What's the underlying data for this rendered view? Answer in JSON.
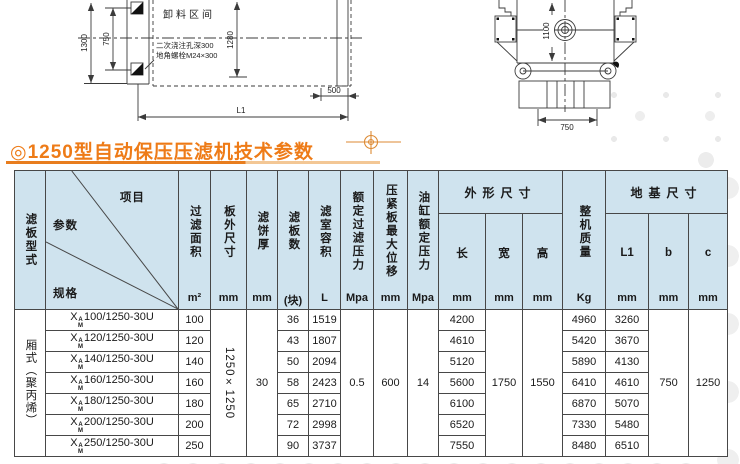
{
  "colors": {
    "accent_orange": "#ee7b17",
    "underline_light": "#f3c795",
    "header_blue": "#cfe3ee",
    "line_dark": "#3b3b3b"
  },
  "page": {
    "title": "◎1250型自动保压压滤机技术参数"
  },
  "drawing": {
    "left": {
      "dim_1300": "1300",
      "dim_750": "750",
      "dim_1280": "1280",
      "dim_500": "500",
      "dim_L1": "L1",
      "unload_zone": "卸料区间",
      "note_line1": "二次浇注孔深300",
      "note_line2": "地角螺栓M24×300"
    },
    "right": {
      "dim_1100": "1100",
      "dim_750": "750"
    }
  },
  "table": {
    "model_prefix": {
      "x": "X",
      "sup": "A",
      "sub": "M"
    },
    "plate_type_value": "厢式（聚丙烯）",
    "columns": {
      "plate_type": {
        "label": "滤板型式"
      },
      "item": "项目",
      "param": "参数",
      "spec": "规格",
      "filter_area": {
        "label": "过滤面积",
        "unit": "m²"
      },
      "plate_size": {
        "label": "板外尺寸",
        "unit": "mm"
      },
      "cake_thickness": {
        "label": "滤饼厚",
        "unit": "mm"
      },
      "plate_count": {
        "label": "滤板数",
        "unit": "(块)"
      },
      "chamber_volume": {
        "label": "滤室容积",
        "unit": "L"
      },
      "rated_filter_pressure": {
        "label": "额定过滤压力",
        "unit": "Mpa"
      },
      "max_displacement": {
        "label": "压紧板最大位移",
        "unit": "mm"
      },
      "cylinder_pressure": {
        "label": "油缸额定压力",
        "unit": "Mpa"
      },
      "overall_size": {
        "label": "外形尺寸"
      },
      "length": {
        "label": "长",
        "unit": "mm"
      },
      "width": {
        "label": "宽",
        "unit": "mm"
      },
      "height": {
        "label": "高",
        "unit": "mm"
      },
      "machine_weight": {
        "label": "整机质量",
        "unit": "Kg"
      },
      "foundation_size": {
        "label": "地基尺寸"
      },
      "l1": {
        "label": "L1",
        "unit": "mm"
      },
      "b": {
        "label": "b",
        "unit": "mm"
      },
      "c": {
        "label": "c",
        "unit": "mm"
      }
    },
    "merged": {
      "plate_size": "1250×1250",
      "cake_thickness": "30",
      "rated_filter_pressure": "0.5",
      "max_displacement": "600",
      "cylinder_pressure": "14",
      "width": "1750",
      "height": "1550",
      "b": "750",
      "c": "1250"
    },
    "rows": [
      {
        "spec": "100/1250-30U",
        "area": "100",
        "plates": "36",
        "volume": "1519",
        "length": "4200",
        "weight": "4960",
        "l1": "3260"
      },
      {
        "spec": "120/1250-30U",
        "area": "120",
        "plates": "43",
        "volume": "1807",
        "length": "4610",
        "weight": "5420",
        "l1": "3670"
      },
      {
        "spec": "140/1250-30U",
        "area": "140",
        "plates": "50",
        "volume": "2094",
        "length": "5120",
        "weight": "5890",
        "l1": "4130"
      },
      {
        "spec": "160/1250-30U",
        "area": "160",
        "plates": "58",
        "volume": "2423",
        "length": "5600",
        "weight": "6410",
        "l1": "4610"
      },
      {
        "spec": "180/1250-30U",
        "area": "180",
        "plates": "65",
        "volume": "2710",
        "length": "6100",
        "weight": "6870",
        "l1": "5070"
      },
      {
        "spec": "200/1250-30U",
        "area": "200",
        "plates": "72",
        "volume": "2998",
        "length": "6520",
        "weight": "7330",
        "l1": "5480"
      },
      {
        "spec": "250/1250-30U",
        "area": "250",
        "plates": "90",
        "volume": "3737",
        "length": "7550",
        "weight": "8480",
        "l1": "6510"
      }
    ]
  }
}
